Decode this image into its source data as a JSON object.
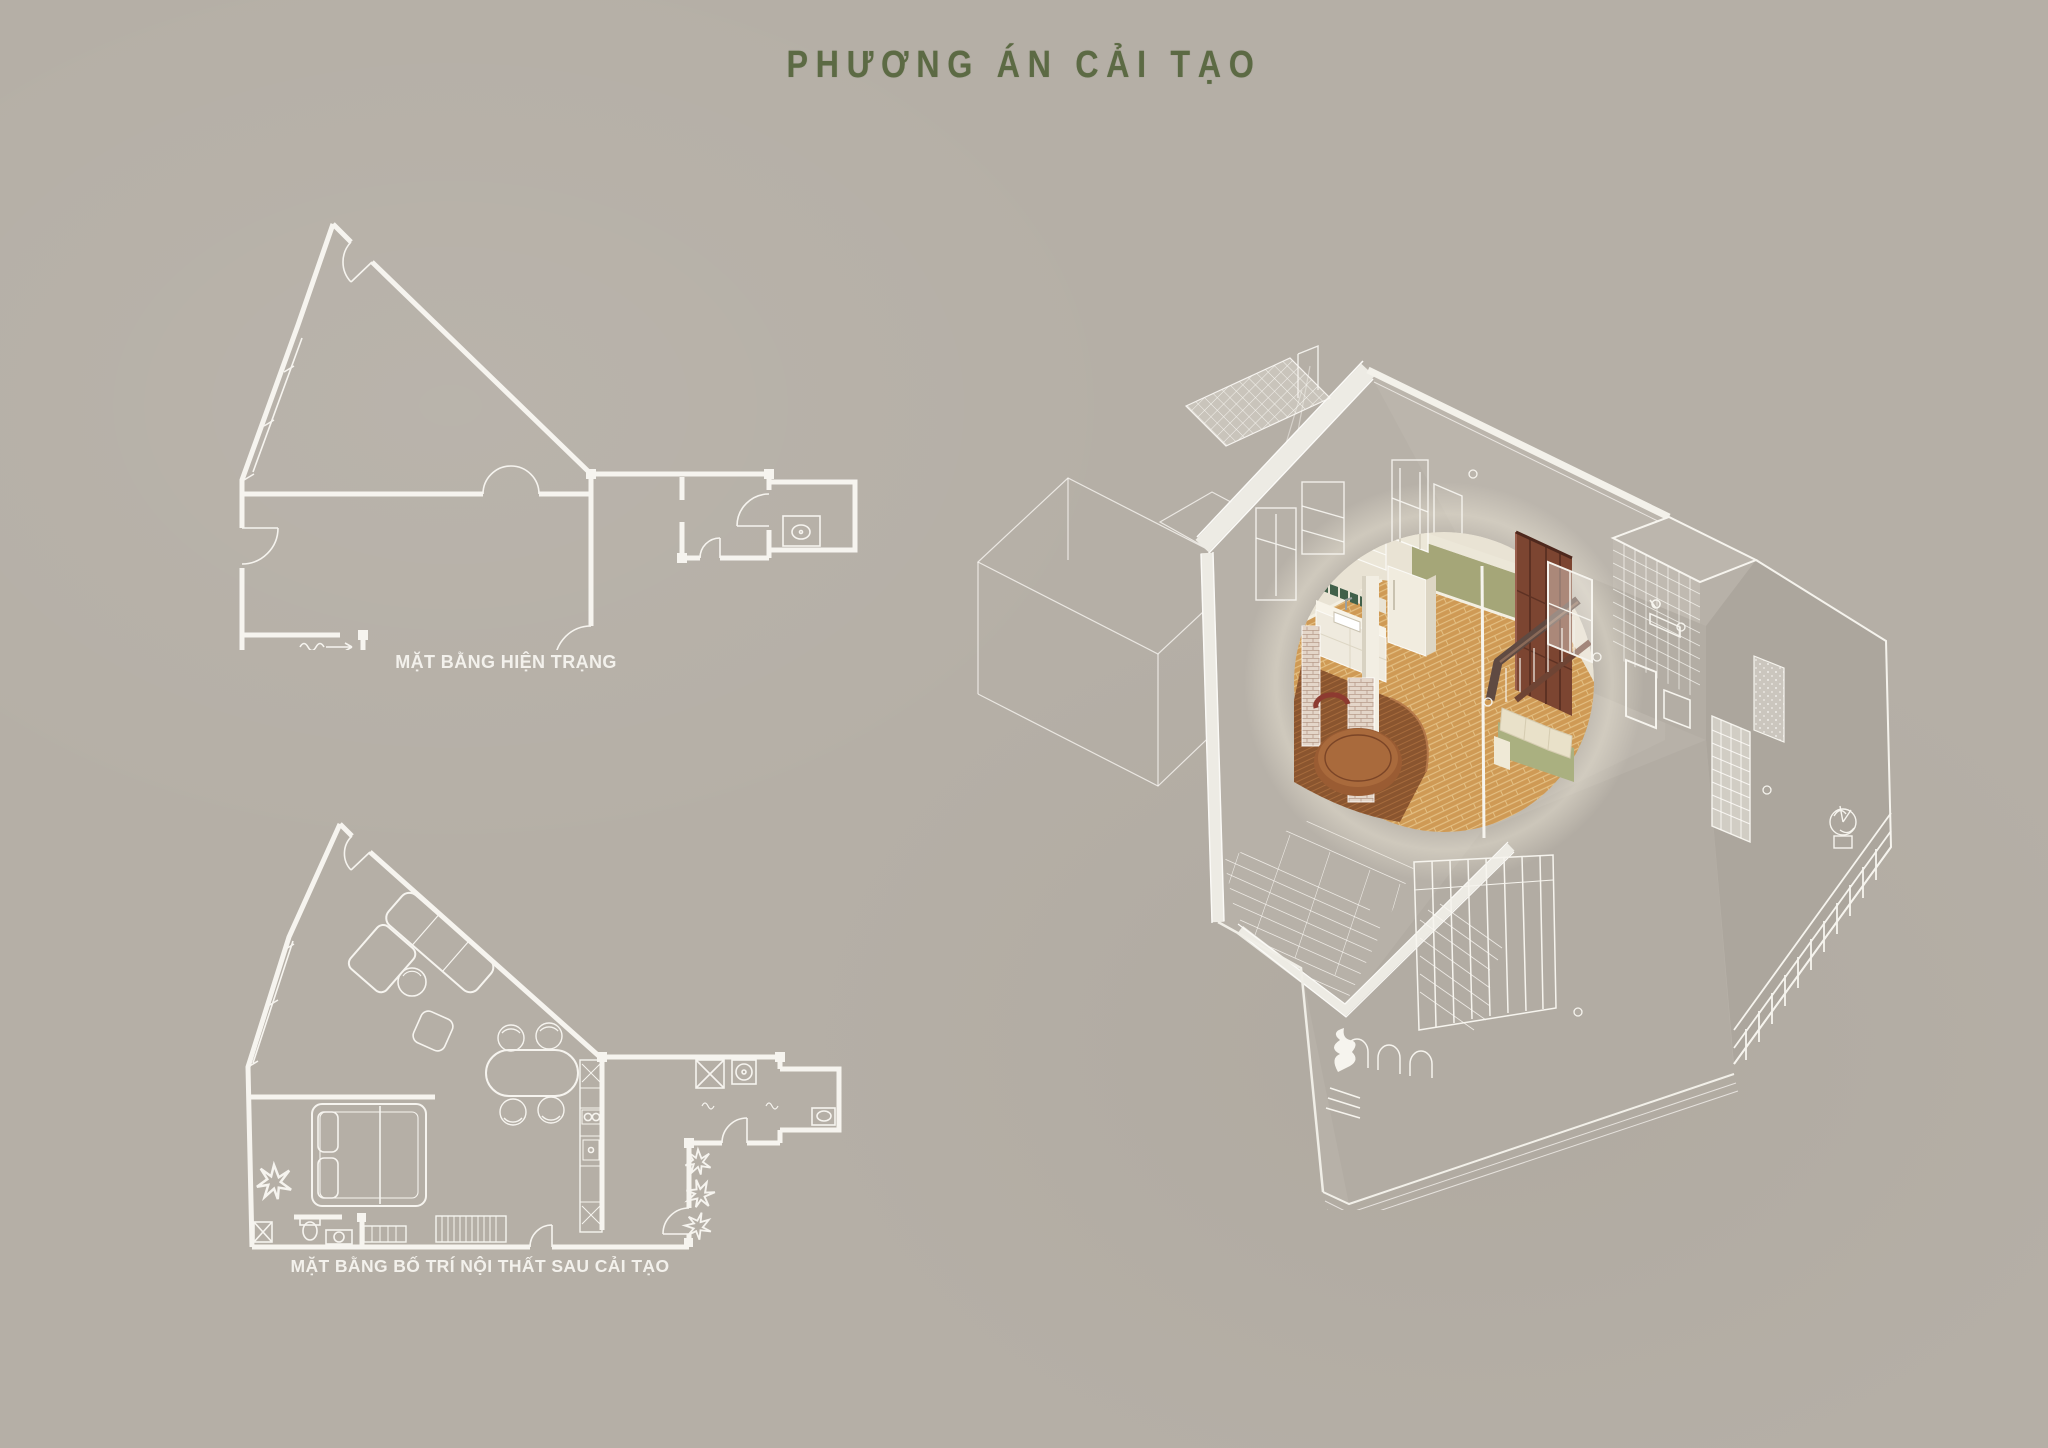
{
  "board": {
    "background": "#b5afa6",
    "width": 2048,
    "height": 1448
  },
  "title": {
    "text": "PHƯƠNG ÁN CẢI TẠO",
    "color": "#5c6a44"
  },
  "figures": {
    "existing_plan": {
      "label": "MẶT BẰNG HIỆN TRẠNG",
      "label_color": "#f3f1ec",
      "line_color": "#f6f4ef"
    },
    "renovated_plan": {
      "label": "MẶT BẰNG BỐ TRÍ NỘI THẤT SAU CẢI TẠO",
      "label_color": "#f3f1ec",
      "line_color": "#f6f4ef"
    },
    "axonometric": {
      "name": "axonometric-cutaway-render",
      "palette": {
        "line_white": "#f6f4ee",
        "wall_taupe": "#b7b1a8",
        "floor_wood": "#cf9a55",
        "floor_seam": "#e3bf83",
        "platform_wood": "#8a552f",
        "wall_green": "#a5a678",
        "sofa_green": "#aab080",
        "cushion_cream": "#e9e1c9",
        "cabinet_cream": "#efeade",
        "dark_wood": "#7c4531",
        "table_wood": "#9a5c33",
        "brick": "#e4d6c9"
      }
    }
  }
}
